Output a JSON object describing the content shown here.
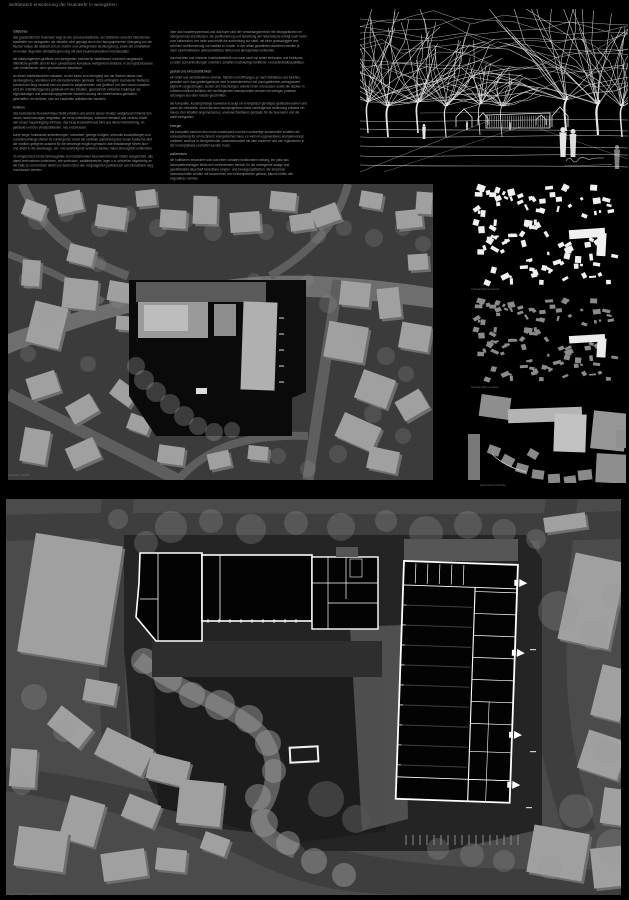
{
  "board": {
    "title": "wettbewerb erweiterung der feuerwehr in weingarten"
  },
  "essay": {
    "columns": [
      {
        "blocks": [
          {
            "t": "h",
            "text": "städtebau"
          },
          {
            "t": "p",
            "text": "das grundstück der feuerwehr liegt an der schussentalstraße, am südlichen rand der historischen stadtmitte von weingarten. die situation wird geprägt durch den topographischen übergang von der flachen talaue der altstadt zum st. martin- und umliegenden siedlungsberg, sowie der unmittelbar im norden liegenden altstadtbegrenzung mit dem baumbestandenen münsterplatz."
          },
          {
            "t": "p",
            "text": "die stadtprägenden gebäude von weingarten: historische stadthäuser, kirchliche langbauten, öffentliche gehöfte sind im kern gewachsene komplexe, weitgehend einfache, in sich geschlossene oder freistehende, oben geometrische baukörper."
          },
          {
            "t": "p",
            "text": "an dieser städtebaulichen situation, an der kante zum übergang von der flachen talaue zum siedlungsberg, orientieren sich die bestehenden gebäude: nicht umfänglich zueinander bleibend, sondern am berg versetzt und zur stadt hin aufgenommen und geöffnet. mit dem neuen baustein wird ein ortsbildprägendes gebäude mit den inhalten, geometrisch einfacher baukörper als eigenständiger und ausrichtungsgebender baustein analog den bestehenden gebäuden geschaffen. ein äußerer, sich zur stadtmitte aufklärender baustein."
          },
          {
            "t": "h",
            "text": "funktion"
          },
          {
            "t": "p",
            "text": "das bestehende feuerwehrhaus bleibt erhalten und wird in seiner struktur weitgehend minimal den neuen raumnutzungen umgebaut. der neue hallenkörper, zwischen bestand und neubau, bildet den neuen haupteingang mit foyer. das neue feuerwehrhaus wird aus dieser blickrichtung, im gebäude und den einsatzabläufen, neu erschlossen."
          },
          {
            "t": "p",
            "text": "kurze wege, funktionale anforderungen, robustheit, geringe budgets, sinnvolle zuschaltungen und zusammenhänge stehen im vordergrund. durch die vertikale ausrichtung des neuen baukerns wird die nördlich gelegene ausfahrt für die fahrzeuge möglich gemacht; alle einsatzwege führen kurz und direkt in die alarmwege, ein- und ausrückende verkehre bleiben dabei störungsfrei entflochten."
          },
          {
            "t": "p",
            "text": "im erdgeschoss ist die fahrzeughalle zum bestehenden feuerwehrhof nach süden ausgerichtet. alle damit verbundenen funktionen, wie schleusen, sanitärbereiche, lager u.a. schließen folgerichtig an die halle an und können direkt von außen über den vorgelagerten parkbereich auf schnellstem weg erschlossen werden."
          }
        ]
      },
      {
        "blocks": [
          {
            "t": "p",
            "text": "über das haupttreppenhaus und das foyer sind der verwaltungsbereich mit übungsräumen im obergeschoss erschlossen. die positionierung und belichtung der nebenräume erfolgt nach innen zum hallenraum; der helle saal erhält die ausrichtung zur stadt, mit einer grosszügigen und schönen sichtbeziehung zur basilika st. martin. in der urban gestalteten dachform werden je nach raumfunktionen unterschiedliche höhen und atmosphären entworfen."
          },
          {
            "t": "p",
            "text": "durchsichten und einfache funktionsabläufe von west nach ost sowie einbauten und freiräume, zu allen sonnenrichtungen orientiert, schaffen hochwertige funktions- und aufenthaltsqualitäten."
          },
          {
            "t": "h",
            "text": "gestalt und wirtschaftlichkeit"
          },
          {
            "t": "p",
            "text": "ein relief aus verschiedenen ebenen, flächen und öffnungen, je nach städtebau und funktion, gestaltet sich. das gesamtgebäude wird in werksteinbeton mit durchgefärbtem weissgrauem pigment vorgeschlagen; sockel und böschungen, wände innen und aussen sowie die decken in rohbeton bleiben sichtbar. die hochliegenden wandschotten werden mit wenigen präzisen setzungen aus dem massiv geschnitten."
          },
          {
            "t": "p",
            "text": "die kompakte, kostengünstige bauweise erzeugt ein energetisch günstiges gebäudevolumen und gutes a/v-verhältnis. durch die dem raumprogramm direkt nachfolgende bedienung entsteht ein neues, den inhalten angemessenes, unverwechselbares gebäude für die feuerwehr und die stadt weingarten."
          },
          {
            "t": "h",
            "text": "energie"
          },
          {
            "t": "p",
            "text": "die kompakte bauform des neuen baukörpers und die hochwertige aussenhülle schaffen die voraussetzung für ein technisch energetisches haus. es wird ein regeneratives energiekonzept realisiert, welches in übergreifender zusammenarbeit mit dem bauherrn und den ingenieuren in der konzeptphase erarbeitet werden muss."
          },
          {
            "t": "h",
            "text": "außenraum"
          },
          {
            "t": "p",
            "text": "die hofflächen entwickeln sich aus einer robusten funktionalen haltung. ein platz aus betonplattenbelägen bildet den verbindenden bereich für die umliegende anlage und gewährleistet dauerhaft belastbare rangier- und bewegungsflächen. die einzelnen raumabschnitte werden mit baumreihen und heckenpaketen gefasst; bäume bilden den vegetativen rahmen."
          },
          {
            "t": "p",
            "text": "im norden die hochstämme um den obst- und bauerngarten, die die gärten der stadt inszenieren; als lockere, heimische gruppierungen zur begrünung in der neuen ortskante gepflanzt."
          }
        ]
      }
    ]
  },
  "panels": {
    "site_plan": {
      "caption": "lageplan 1:1000"
    },
    "fg_existing": {
      "caption": "schwarzplan bestand"
    },
    "fg_proposed": {
      "caption": "schwarzplan neubau"
    },
    "detail": {
      "caption": "ausschnitt ortsmitte"
    },
    "master": {
      "caption": "lageplan mit erdgeschoss 1:500"
    }
  },
  "colors": {
    "sheet_bg": "#000000",
    "body_text": "#9b9b9b",
    "heading_text": "#b4b4b4",
    "caption_text": "#6f6f6f",
    "map_bg": "#3b3b3b",
    "map_road": "#5e5e5e",
    "map_band": "#787878",
    "building": "#a0a0a0",
    "building_shadow": "#6e6e6e",
    "tree": "#9a9a9a",
    "site_black": "#0a0a0a",
    "master_bg": "#4b4b4b",
    "master_road": "#3e3e3e",
    "plot": "#242424",
    "yard": "#1c1c1c",
    "apron": "#545454",
    "plan_fill": "#030303",
    "plan_line": "#ffffff",
    "fg_white": "#f0f0f0",
    "fg_gray": "#8a8a8a",
    "sketch_line": "#e6e6e6"
  }
}
